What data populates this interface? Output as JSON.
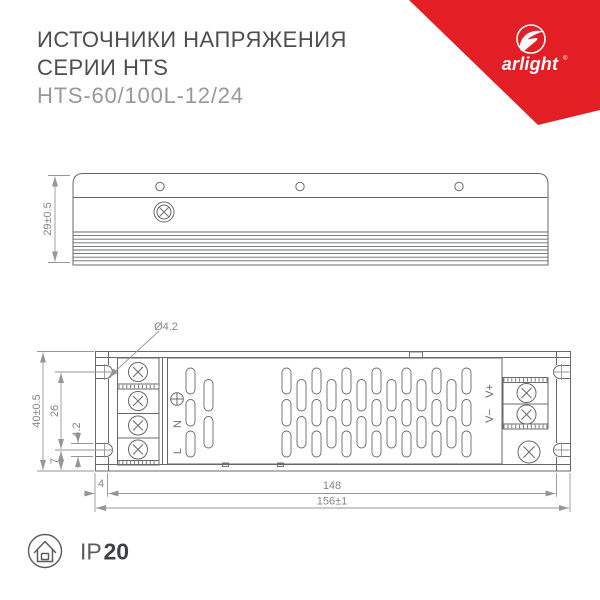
{
  "header": {
    "title_line1": "ИСТОЧНИКИ НАПРЯЖЕНИЯ",
    "title_line2": "СЕРИИ HTS",
    "model": "HTS-60/100L-12/24"
  },
  "logo": {
    "brand": "arlight",
    "reg": "®",
    "color": "#e31e24"
  },
  "top_view": {
    "height_dim": "29±0.5"
  },
  "front_view": {
    "height_dim": "40±0.5",
    "slot_span_dim": "26",
    "slot_width_dim": "4.2",
    "edge_offset_dim": "7",
    "hole_dia_dim": "Ø4.2",
    "flange_dim": "4",
    "body_length_dim": "148",
    "total_length_dim": "156±1",
    "input_labels": [
      "N",
      "L"
    ],
    "output_labels": [
      "V+",
      "V−"
    ]
  },
  "footer": {
    "ip_prefix": "IP",
    "ip_value": "20"
  }
}
